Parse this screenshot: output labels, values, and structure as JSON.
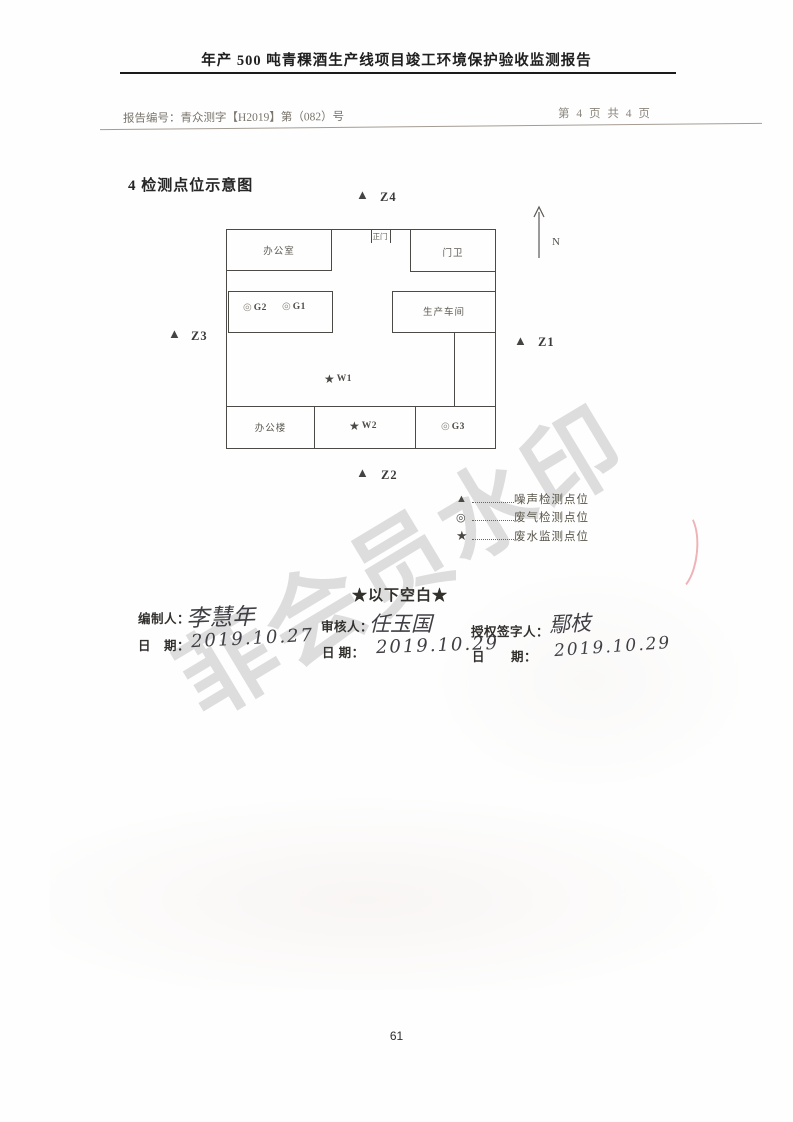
{
  "header": {
    "title": "年产 500 吨青稞酒生产线项目竣工环境保护验收监测报告",
    "report_no": "报告编号：青众测字【H2019】第（082）号",
    "page_indicator": "第 4 页 共 4 页"
  },
  "section": {
    "title": "4 检测点位示意图"
  },
  "diagram": {
    "rooms": {
      "office": "办公室",
      "gate": "正门",
      "guard": "门卫",
      "workshop": "生产车间",
      "office_building": "办公楼"
    },
    "markers": {
      "g1": "G1",
      "g2": "G2",
      "g3": "G3",
      "w1": "W1",
      "w2": "W2",
      "z1": "Z1",
      "z2": "Z2",
      "z3": "Z3",
      "z4": "Z4",
      "north": "N"
    },
    "symbols": {
      "noise": "▲",
      "gas": "◎",
      "water": "★"
    }
  },
  "legend": {
    "items": [
      {
        "symbol": "▲",
        "label": "噪声检测点位"
      },
      {
        "symbol": "◎",
        "label": "废气检测点位"
      },
      {
        "symbol": "★",
        "label": "废水监测点位"
      }
    ]
  },
  "blank_notice": "★以下空白★",
  "signatures": {
    "preparer_label": "编制人：",
    "preparer_name": "李慧年",
    "preparer_date_label": "日　期：",
    "preparer_date": "2019.10.27",
    "reviewer_label": "审核人：",
    "reviewer_name": "任玉国",
    "reviewer_date_label": "日 期：",
    "reviewer_date": "2019.10.29",
    "authorizer_label": "授权签字人：",
    "authorizer_name": "鄢枝",
    "authorizer_date_label": "日　　期：",
    "authorizer_date": "2019.10.29"
  },
  "watermark": "菲会员水印",
  "page_number": "61",
  "colors": {
    "ink": "#4c4a46",
    "light_ink": "#7a756d",
    "watermark": "#d2d2d2",
    "seal_red": "#dd6670"
  }
}
